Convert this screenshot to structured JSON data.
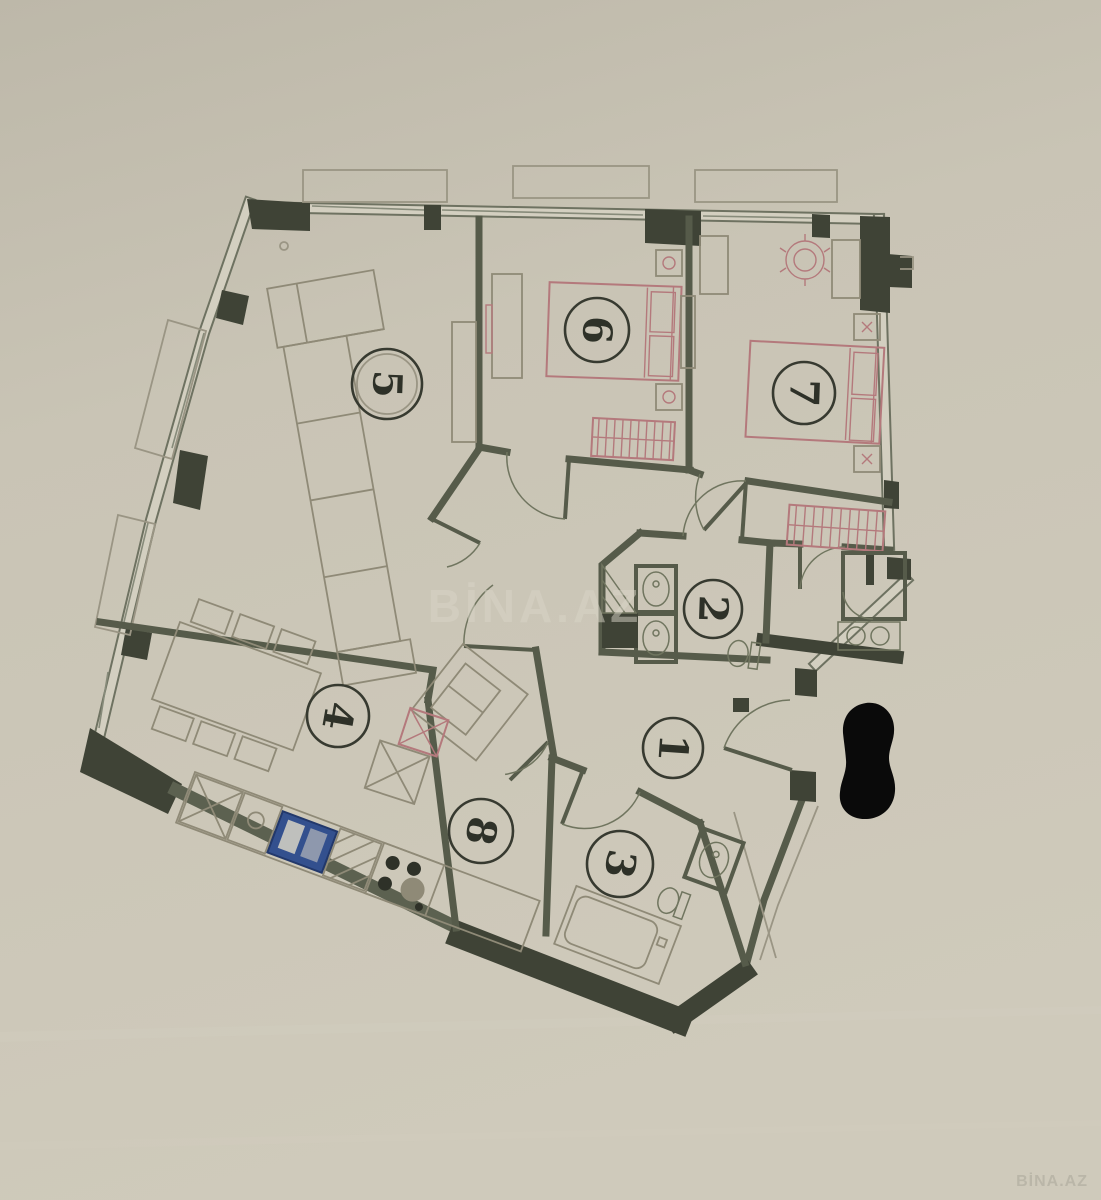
{
  "document": {
    "kind": "scanned apartment floor plan photo"
  },
  "watermarks": {
    "center": "BİNA.AZ",
    "corner": "BİNA.AZ"
  },
  "rooms": [
    {
      "number": "1",
      "icons": [
        "entry-door-arc"
      ]
    },
    {
      "number": "2",
      "icons": [
        "sink-icon",
        "sink-icon",
        "toilet-icon",
        "vent-shaft-icon"
      ]
    },
    {
      "number": "3",
      "icons": [
        "bathtub-icon",
        "toilet-icon",
        "sink-icon"
      ]
    },
    {
      "number": "4",
      "icons": [
        "dining-table-icon",
        "chair-icon",
        "fridge-icon",
        "kitchen-sink-icon",
        "stove-icon",
        "side-table-icon"
      ]
    },
    {
      "number": "5",
      "icons": [
        "corner-sofa-icon",
        "armchair-icon",
        "tv-stand-icon"
      ]
    },
    {
      "number": "6",
      "icons": [
        "double-bed-icon",
        "nightstand-icon",
        "nightstand-icon",
        "wardrobe-icon",
        "dresser-icon"
      ]
    },
    {
      "number": "7",
      "icons": [
        "double-bed-icon",
        "nightstand-icon",
        "nightstand-icon",
        "wardrobe-icon",
        "desk-icon",
        "desk-chair-icon",
        "cabinet-icon"
      ]
    },
    {
      "number": "8",
      "icons": []
    }
  ],
  "fixtures": {
    "shower": "shower-cabin-icon",
    "washer": "washing-machine-icon"
  },
  "redaction": {
    "shape": "black-marker-blob"
  },
  "colors": {
    "paper": "#c8c3b4",
    "wall_dark": "#3f4336",
    "wall_line": "#565b4a",
    "furniture_red": "#b4797c",
    "sink_blue": "#33508e",
    "redaction_black": "#0a0a0a",
    "watermark": "#d9d5c7"
  }
}
